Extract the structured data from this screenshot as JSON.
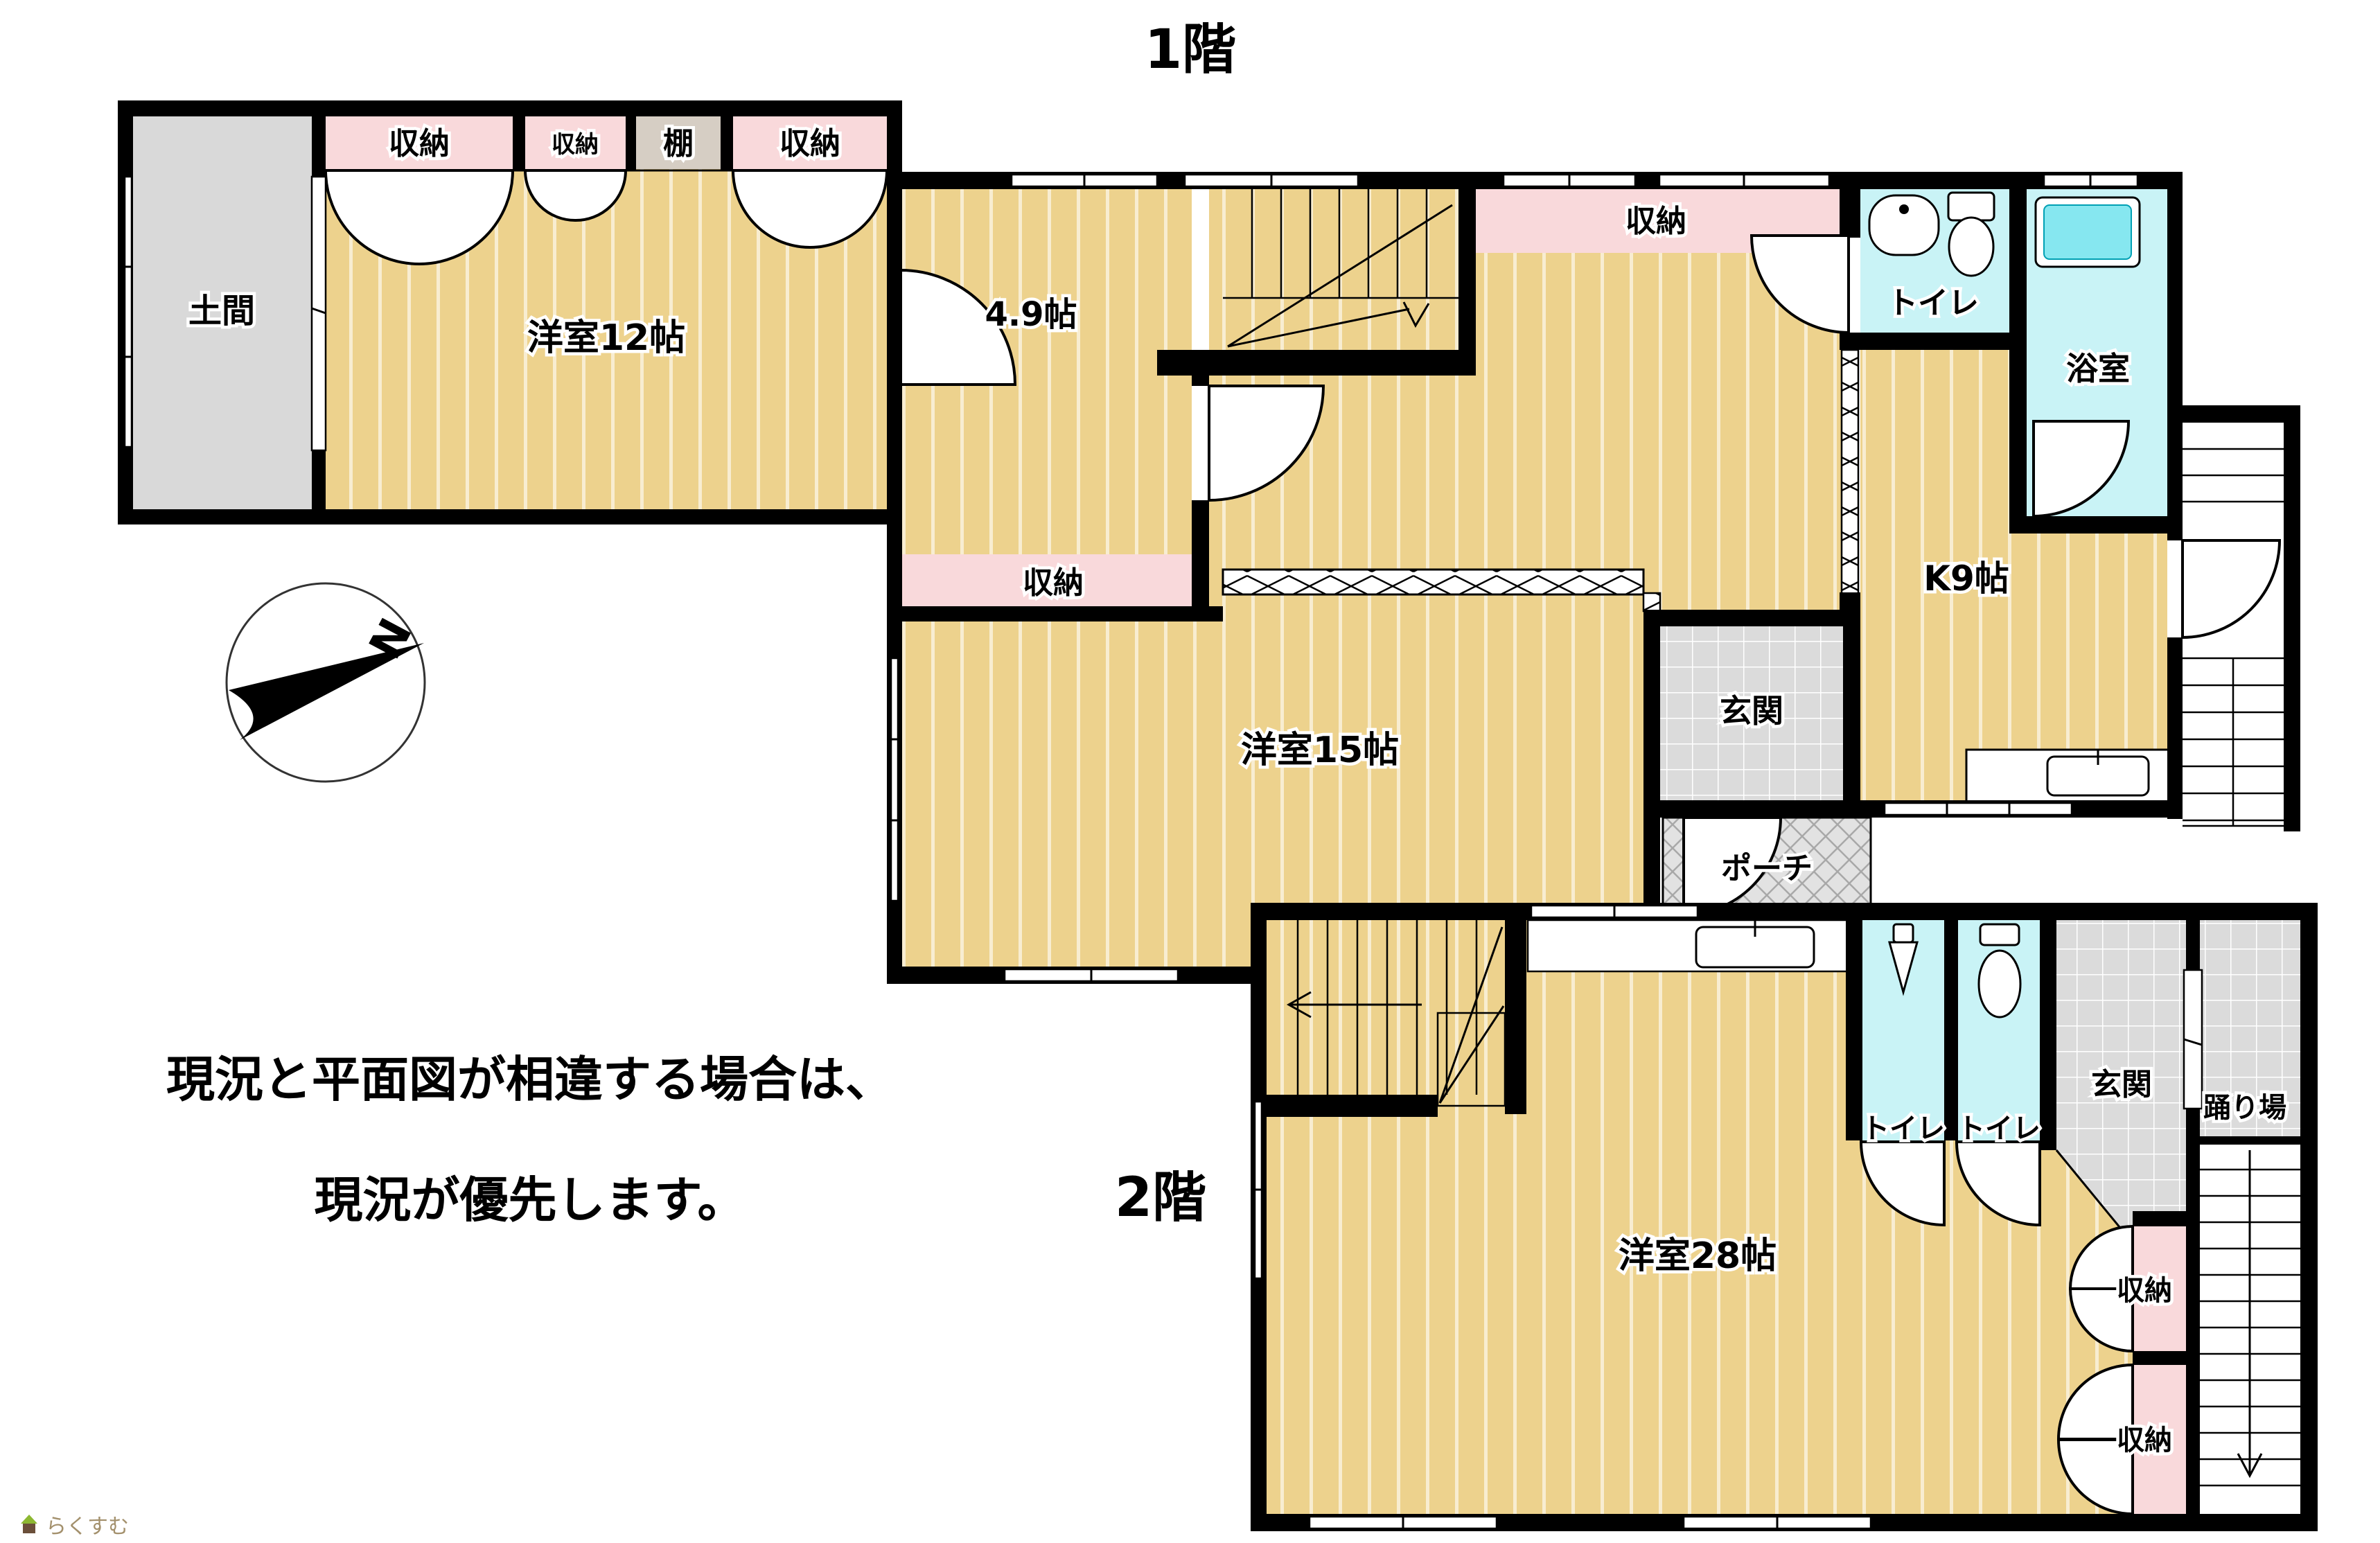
{
  "floor1": {
    "title": "1階",
    "rooms": {
      "doma": "土間",
      "closet_a": "収納",
      "closet_b": "収納",
      "shelf": "棚",
      "closet_c": "収納",
      "yoshitsu12": "洋室12帖",
      "r49": "4.9帖",
      "closet_d": "収納",
      "hall_closet": "収納",
      "toilet": "トイレ",
      "bath": "浴室",
      "k9": "K9帖",
      "yoshitsu15": "洋室15帖",
      "genkan": "玄関",
      "porch": "ポーチ"
    }
  },
  "floor2": {
    "title": "2階",
    "rooms": {
      "toilet_left": "トイレ",
      "toilet_right": "トイレ",
      "genkan": "玄関",
      "odoriba": "踊り場",
      "yoshitsu28": "洋室28帖",
      "closet_upper": "収納",
      "closet_lower": "収納"
    }
  },
  "compass": {
    "north_label": "N"
  },
  "notice": {
    "line1": "現況と平面図が相違する場合は、",
    "line2": "現況が優先します。"
  },
  "watermark": {
    "brand": "らくすむ"
  },
  "colors": {
    "floor_yellow": "#edd28d",
    "closet_pink": "#f9d9db",
    "wet_cyan": "#c9f3f6",
    "tub_cyan": "#86e7f0",
    "tile_gray": "#dbdbdb",
    "shelf_beige": "#d6cec4",
    "wall_black": "#000000"
  }
}
